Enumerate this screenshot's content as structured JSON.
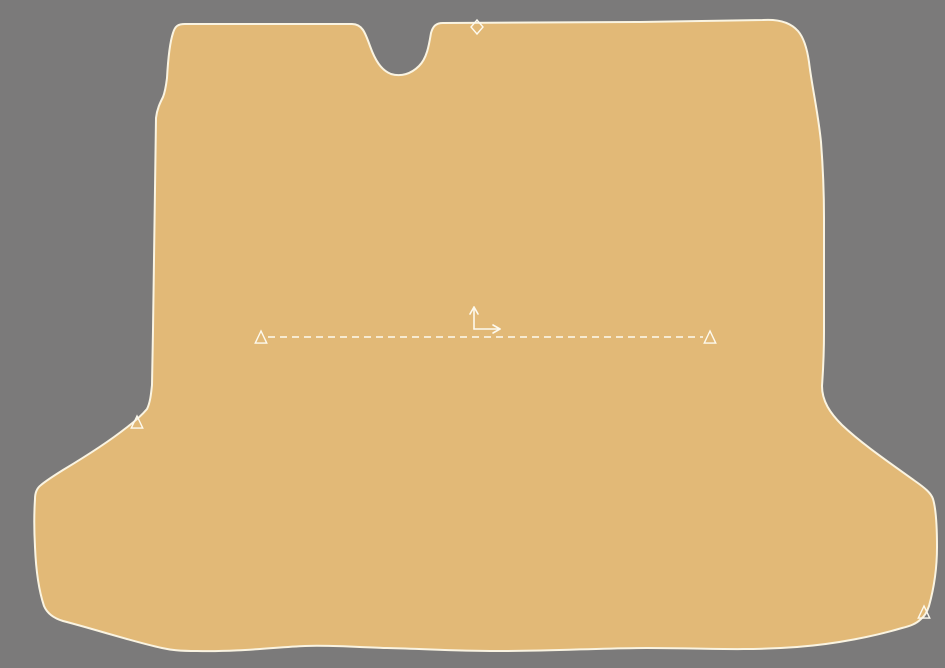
{
  "canvas": {
    "width": 945,
    "height": 668,
    "background_color": "#7B7A7A",
    "piece_fill_color": "#E2B977",
    "outline_color": "#FAF4E2",
    "marker_color": "#FDFAEF"
  },
  "piece": {
    "outline_path": "M 185,24 L 352,24 C 362,24 365,32 370,46 C 375,60 381,70 391,74 C 401,77 411,74 419,66 C 427,58 429,45 431,33 C 433,26 436,23 443,23 L 640,22 L 763,20 C 779,19 791,23 798,31 C 804,38 807,48 809,62 C 812,87 818,112 821,142 C 823,168 824,190 824,218 L 824,332 C 824,355 823,372 822,386 C 822,401 830,413 842,425 C 862,444 890,463 915,481 C 925,488 931,493 933,499 C 936,509 937,523 937,547 C 937,567 934,588 929,606 C 927,612 925,616 921,619 C 916,624 910,626 902,628 C 875,636 837,644 797,647 C 743,651 699,648 647,648 C 597,648 558,651 497,651 C 454,651 428,649 387,648 C 351,647 329,645 305,646 C 277,647 239,652 197,651 C 179,651 171,650 162,648 C 134,642 94,629 63,621 C 53,618 47,613 44,606 C 39,591 36,571 35,547 C 34,529 34,514 35,499 C 35,493 37,488 41,485 C 47,480 55,475 63,470 C 83,458 107,443 126,428 C 134,422 142,415 147,409 C 150,403 151,395 152,385 L 153,330 L 156,118 C 157,109 160,103 163,97 C 165,92 166,86 167,78 C 168,60 170,42 173,33 C 175,26 178,24 185,24 Z"
  },
  "markers": {
    "diamond": {
      "x": 477,
      "y": 27,
      "rx": 6,
      "ry": 7
    },
    "triangles": [
      {
        "x": 261,
        "y": 338,
        "size": 7
      },
      {
        "x": 710,
        "y": 338,
        "size": 7
      },
      {
        "x": 137,
        "y": 423,
        "size": 7
      },
      {
        "x": 924,
        "y": 613,
        "size": 7
      }
    ]
  },
  "grain_line": {
    "x1": 268,
    "y1": 337,
    "x2": 703,
    "y2": 337,
    "dash": "7 5"
  },
  "axis_indicator": {
    "origin": {
      "x": 474,
      "y": 329
    },
    "up_arrow_length": 22,
    "right_arrow_length": 26
  }
}
